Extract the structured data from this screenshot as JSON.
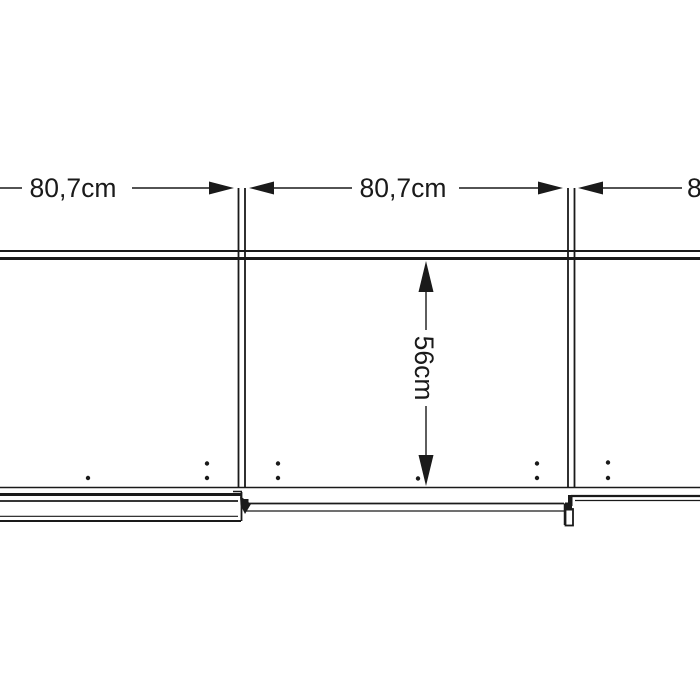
{
  "page": {
    "background": "#ffffff"
  },
  "drawing": {
    "kind": "wardrobe-plan-view-dimension-drawing",
    "line_color": "#1a1a1a",
    "labels": {
      "width_left": "80,7cm",
      "width_middle": "80,7cm",
      "width_right": "80,7cm",
      "depth": "56cm"
    }
  }
}
